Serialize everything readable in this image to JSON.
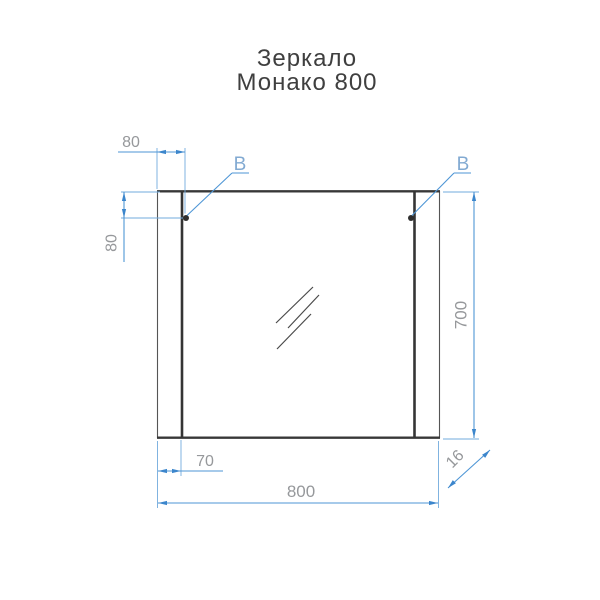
{
  "title": {
    "line1": "Зеркало",
    "line2": "Монако 800"
  },
  "labels": {
    "mount_left": "B",
    "mount_right": "B"
  },
  "dimensions": {
    "mount_offset_top": "80",
    "mount_offset_side": "80",
    "height": "700",
    "strip_width": "70",
    "width": "800",
    "depth": "16"
  },
  "colors": {
    "background": "#ffffff",
    "drawing_line": "#353535",
    "dimension_line": "#4e96d6",
    "dimension_text": "#96989b",
    "mount_label": "#82aad2",
    "title_text": "#3f3f3f",
    "mount_dot": "#2f2f2f"
  }
}
